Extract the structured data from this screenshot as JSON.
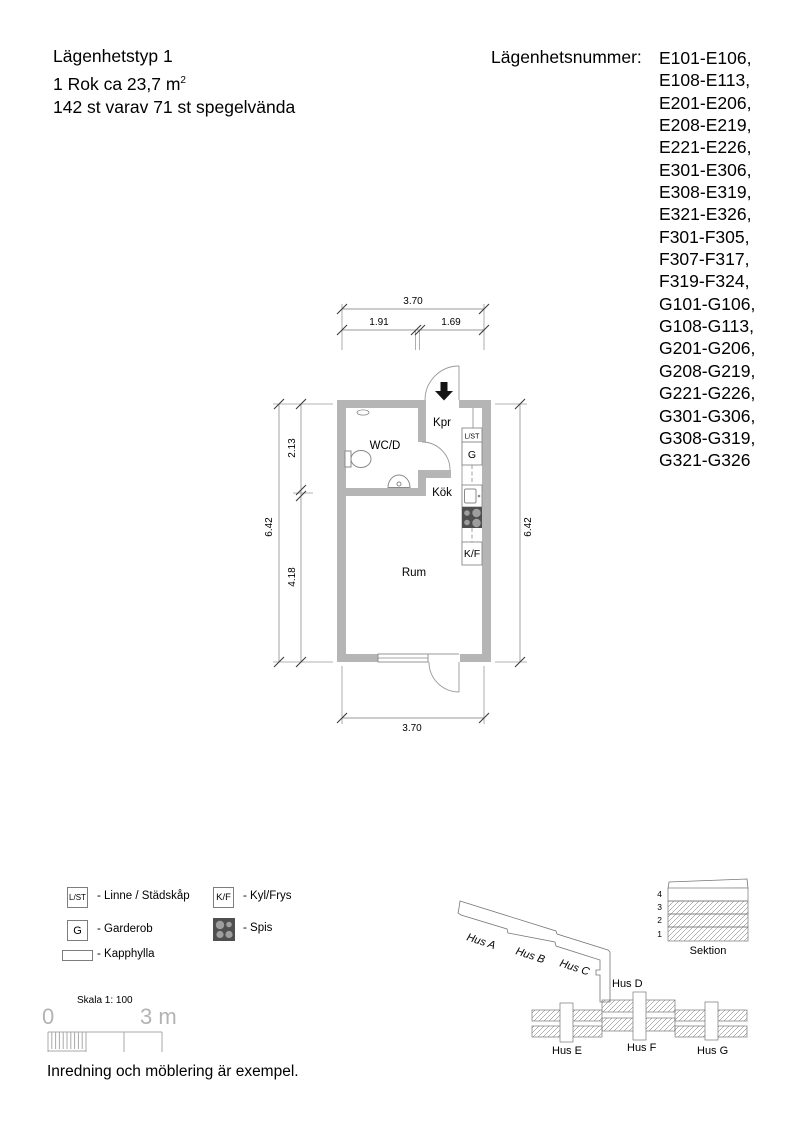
{
  "header": {
    "type_title": "Lägenhetstyp 1",
    "size_line": "1 Rok ca 23,7 m",
    "size_sup": "2",
    "count_line": "142 st varav 71 st spegelvända",
    "numbers_label": "Lägenhetsnummer:",
    "numbers": [
      "E101-E106,",
      "E108-E113,",
      "E201-E206,",
      "E208-E219,",
      "E221-E226,",
      "E301-E306,",
      "E308-E319,",
      "E321-E326,",
      "F301-F305,",
      "F307-F317,",
      "F319-F324,",
      "G101-G106,",
      "G108-G113,",
      "G201-G206,",
      "G208-G219,",
      "G221-G226,",
      "G301-G306,",
      "G308-G319,",
      "G321-G326"
    ]
  },
  "plan": {
    "rooms": {
      "kpr": "Kpr",
      "wcd": "WC/D",
      "kok": "Kök",
      "rum": "Rum"
    },
    "cabinets": {
      "lst": "L/ST",
      "g": "G",
      "kf": "K/F"
    },
    "dims": {
      "top_total": "3.70",
      "top_left": "1.91",
      "top_right": "1.69",
      "left_total": "6.42",
      "left_upper": "2.13",
      "left_lower": "4.18",
      "right_total": "6.42",
      "bottom_total": "3.70"
    }
  },
  "legend": {
    "lst_symbol": "L/ST",
    "lst_label": "- Linne / Städskåp",
    "g_symbol": "G",
    "g_label": "- Garderob",
    "kapphylla_label": "- Kapphylla",
    "kf_symbol": "K/F",
    "kf_label": "- Kyl/Frys",
    "spis_label": "- Spis"
  },
  "scale_bar": {
    "title": "Skala 1: 100",
    "zero": "0",
    "end": "3 m"
  },
  "site": {
    "hus_a": "Hus A",
    "hus_b": "Hus B",
    "hus_c": "Hus C",
    "hus_d": "Hus D",
    "hus_e": "Hus E",
    "hus_f": "Hus F",
    "hus_g": "Hus G",
    "sektion": "Sektion",
    "floors": [
      "4",
      "3",
      "2",
      "1"
    ]
  },
  "footer_note": "Inredning och möblering är exempel.",
  "colors": {
    "wall": "#b5b5b5",
    "stove": "#4f4f4f",
    "burner": "#9e9e9e",
    "line": "#8a8a8a"
  }
}
